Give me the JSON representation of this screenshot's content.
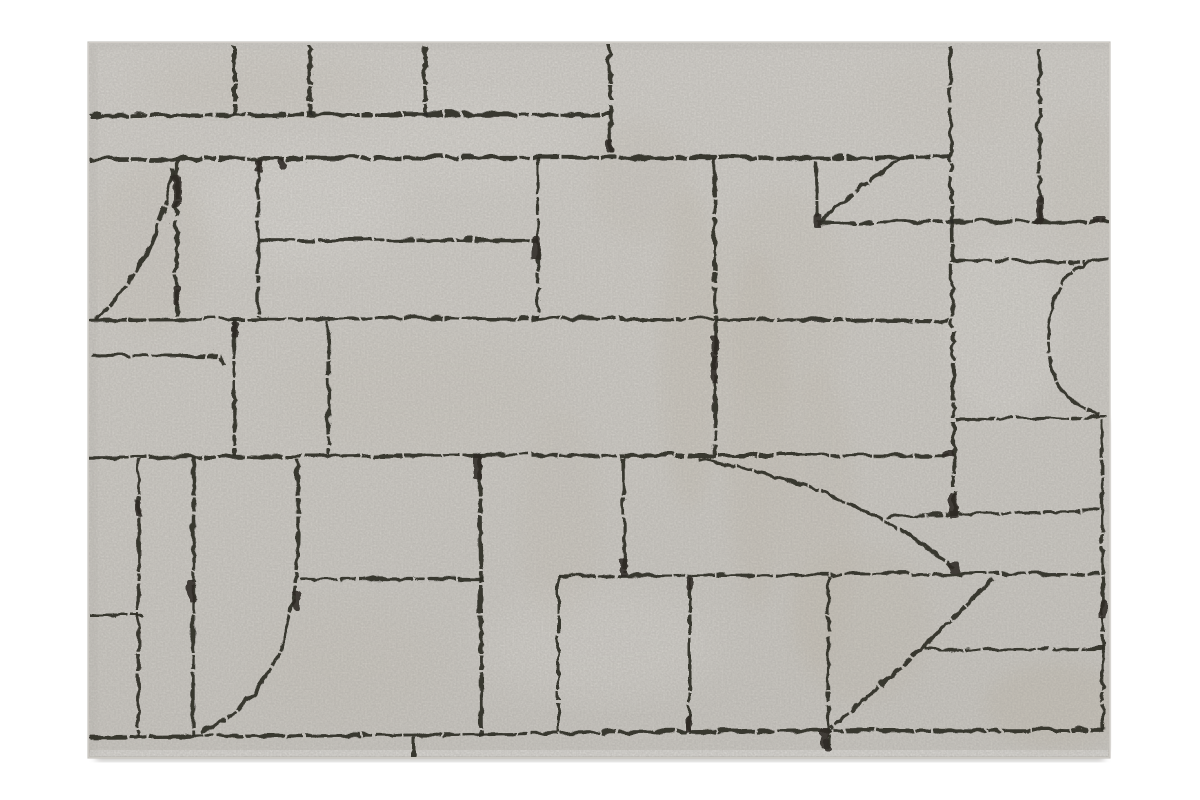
{
  "meta": {
    "description": "Product photograph of a rectangular cream greige area rug with an abstract hand-drawn charcoal line pattern of irregular blocks and quarter-circle curves, on a white background",
    "background_color": "#ffffff"
  },
  "rug": {
    "x": 88,
    "y": 42,
    "width": 1022,
    "height": 716,
    "base_color_top": "#dedbd6",
    "base_color_mid": "#d9d6d0",
    "base_color_bottom": "#d3d0ca",
    "edge_color": "#c6c3bd",
    "line_color": "#2d2a25",
    "pile_edge_color": "#e7e5e1"
  },
  "shadows": {
    "bottom": {
      "x": 96,
      "y": 750,
      "w": 1008,
      "h": 11,
      "color": "#8a8783",
      "opacity": 0.5
    },
    "right": {
      "x": 1106,
      "y": 420,
      "w": 5,
      "h": 330,
      "color": "#b3b0ab",
      "opacity": 0.35
    },
    "left_inner": {
      "x": 88,
      "y": 46,
      "w": 9,
      "h": 708,
      "color": "#c2bfb9",
      "opacity": 0.35
    },
    "top_inner": {
      "x": 88,
      "y": 42,
      "w": 1022,
      "h": 7,
      "color": "#c6c3bd",
      "opacity": 0.3
    }
  },
  "pattern": {
    "default_width": 3.2,
    "dash": "38 2 16 3 54 2 10 3 27 2",
    "lines": [
      {
        "n": "top-band-h",
        "d": "M88 114 L350 112.5 L608 113",
        "w": 4
      },
      {
        "n": "second-h",
        "d": "M88 158 L500 156 L948 156",
        "w": 4.2
      },
      {
        "n": "short-h-238",
        "d": "M257 239 L536 238",
        "w": 3.4
      },
      {
        "n": "h-318",
        "d": "M88 318 L400 316.5 L714 317.5 L948 319",
        "w": 3.6
      },
      {
        "n": "h-222-right",
        "d": "M816 222 L960 220 L1108 220",
        "w": 3.4
      },
      {
        "n": "h-353-left",
        "d": "M90 354 L218 355 L222 363",
        "w": 3.4
      },
      {
        "n": "h-258-right",
        "d": "M952 258 L1083 261",
        "w": 3
      },
      {
        "n": "h-454",
        "d": "M88 456 L500 453.5 L948 454",
        "w": 3.5
      },
      {
        "n": "h-417-right",
        "d": "M955 417 L1104 416",
        "w": 3
      },
      {
        "n": "h-512-right",
        "d": "M884 516 L955 512 L1099 509",
        "w": 2.8
      },
      {
        "n": "h-577-left",
        "d": "M298 577 L481 577",
        "w": 3.2
      },
      {
        "n": "h-573-right",
        "d": "M557 574 L820 573 L1097 572",
        "w": 3.2
      },
      {
        "n": "h-613-left",
        "d": "M88 613 L140 613",
        "w": 3
      },
      {
        "n": "h-647-right",
        "d": "M923 648 L1101 647",
        "w": 3
      },
      {
        "n": "h-bottom",
        "d": "M88 735 L412 733 L688 730 L828 728.5 L1102 728",
        "w": 3.8
      },
      {
        "n": "v-stub-233",
        "d": "M233 44 L233 113",
        "w": 4
      },
      {
        "n": "v-stub-308",
        "d": "M308 44 L308 113",
        "w": 3.8
      },
      {
        "n": "v-stub-423",
        "d": "M423 44 L423 113",
        "w": 3.8
      },
      {
        "n": "v-step-608",
        "d": "M608 43 L609 152",
        "w": 4
      },
      {
        "n": "v-948-long",
        "d": "M948 46 L951 300 L953 513",
        "w": 3.6
      },
      {
        "n": "v-1038",
        "d": "M1038 46 L1038 220",
        "w": 3.4
      },
      {
        "n": "v-175",
        "d": "M175 159 L175 316",
        "w": 4.2
      },
      {
        "n": "v-257",
        "d": "M257 159 L257 317",
        "w": 3.4
      },
      {
        "n": "v-537",
        "d": "M537 157 L537 317",
        "w": 3.2
      },
      {
        "n": "v-712",
        "d": "M713 157 L714 453",
        "w": 3.6
      },
      {
        "n": "v-814",
        "d": "M814 159 L815 219",
        "w": 3.4
      },
      {
        "n": "v-232",
        "d": "M232 319 L233 454",
        "w": 4
      },
      {
        "n": "v-327",
        "d": "M327 319 L327 453",
        "w": 3.2
      },
      {
        "n": "v-137",
        "d": "M137 456 L137 734",
        "w": 2.8
      },
      {
        "n": "v-192",
        "d": "M192 456 L192 733",
        "w": 3.4
      },
      {
        "n": "v-478",
        "d": "M478 456 L480 734",
        "w": 3.8
      },
      {
        "n": "v-557",
        "d": "M557 576 L557 730",
        "w": 3
      },
      {
        "n": "v-622",
        "d": "M622 456 L623 573",
        "w": 3.2
      },
      {
        "n": "v-688",
        "d": "M688 576 L688 728",
        "w": 3
      },
      {
        "n": "v-827",
        "d": "M827 575 L827 747",
        "w": 3.2
      },
      {
        "n": "v-1100",
        "d": "M1100 418 L1102 728",
        "w": 3.2
      },
      {
        "n": "tick-412",
        "d": "M412 734 L412 757",
        "w": 4
      },
      {
        "n": "curve-sail-top-left",
        "d": "M171 166 Q160 256 95 317",
        "w": 3.6
      },
      {
        "n": "curve-sail-top-mid",
        "d": "M899 158 Q857 186 818 220",
        "w": 3.4
      },
      {
        "n": "curve-c-right",
        "d": "M1107 257 Q1052 262 1047 330 Q1043 396 1097 412",
        "w": 3.2
      },
      {
        "n": "curve-sail-bottom-left",
        "d": "M296 456 C298 580 301 688 198 731",
        "w": 3.5
      },
      {
        "n": "curve-arc-middle",
        "d": "M696 457 Q862 487 954 569",
        "w": 3.3
      },
      {
        "n": "diagonal-bottom-right",
        "d": "M991 577 Q918 652 829 727",
        "w": 3.6
      }
    ],
    "blobs": [
      [
        471,
        452,
        8,
        26
      ],
      [
        530,
        234,
        8,
        24
      ],
      [
        709,
        334,
        7,
        46
      ],
      [
        947,
        490,
        9,
        26
      ],
      [
        811,
        212,
        9,
        14
      ],
      [
        1090,
        216,
        14,
        6
      ],
      [
        819,
        726,
        8,
        20
      ],
      [
        187,
        578,
        7,
        24
      ],
      [
        1098,
        598,
        7,
        20
      ],
      [
        229,
        320,
        7,
        16
      ],
      [
        1034,
        194,
        7,
        28
      ],
      [
        618,
        556,
        7,
        18
      ],
      [
        684,
        574,
        7,
        14
      ],
      [
        683,
        714,
        7,
        16
      ],
      [
        822,
        737,
        7,
        12
      ],
      [
        948,
        561,
        11,
        10
      ],
      [
        941,
        449,
        11,
        8
      ],
      [
        292,
        590,
        6,
        18
      ],
      [
        133,
        498,
        6,
        16
      ],
      [
        604,
        138,
        8,
        14
      ],
      [
        253,
        158,
        7,
        12
      ],
      [
        171,
        173,
        8,
        34
      ],
      [
        171,
        283,
        7,
        20
      ],
      [
        277,
        157,
        7,
        10
      ]
    ],
    "mottles": [
      {
        "cx": 260,
        "cy": 85,
        "rx": 120,
        "ry": 30,
        "f": "#cbc3b4",
        "o": 0.22
      },
      {
        "cx": 150,
        "cy": 250,
        "rx": 60,
        "ry": 85,
        "f": "#ccc4b6",
        "o": 0.2
      },
      {
        "cx": 420,
        "cy": 390,
        "rx": 140,
        "ry": 60,
        "f": "#cfc8ba",
        "o": 0.17
      },
      {
        "cx": 640,
        "cy": 180,
        "rx": 50,
        "ry": 60,
        "f": "#ccc4b6",
        "o": 0.2
      },
      {
        "cx": 690,
        "cy": 350,
        "rx": 30,
        "ry": 160,
        "f": "#cbc2b2",
        "o": 0.3
      },
      {
        "cx": 757,
        "cy": 430,
        "rx": 32,
        "ry": 180,
        "f": "#c9c0b0",
        "o": 0.28
      },
      {
        "cx": 820,
        "cy": 520,
        "rx": 36,
        "ry": 150,
        "f": "#ccc4b6",
        "o": 0.28
      },
      {
        "cx": 780,
        "cy": 300,
        "rx": 70,
        "ry": 110,
        "f": "#d0c9bc",
        "o": 0.25
      },
      {
        "cx": 862,
        "cy": 625,
        "rx": 70,
        "ry": 80,
        "f": "#cbc3b4",
        "o": 0.26
      },
      {
        "cx": 1055,
        "cy": 705,
        "rx": 70,
        "ry": 42,
        "f": "#c8bfae",
        "o": 0.35
      },
      {
        "cx": 950,
        "cy": 95,
        "rx": 85,
        "ry": 40,
        "f": "#d1cabe",
        "o": 0.16
      },
      {
        "cx": 350,
        "cy": 665,
        "rx": 95,
        "ry": 60,
        "f": "#cfc8ba",
        "o": 0.18
      },
      {
        "cx": 560,
        "cy": 520,
        "rx": 40,
        "ry": 110,
        "f": "#cdc5b7",
        "o": 0.2
      },
      {
        "cx": 1082,
        "cy": 180,
        "rx": 40,
        "ry": 70,
        "f": "#d0c9bc",
        "o": 0.18
      },
      {
        "cx": 300,
        "cy": 205,
        "rx": 100,
        "ry": 60,
        "f": "#eceae6",
        "o": 0.35
      },
      {
        "cx": 600,
        "cy": 645,
        "rx": 120,
        "ry": 55,
        "f": "#e9e7e3",
        "o": 0.3
      },
      {
        "cx": 1002,
        "cy": 330,
        "rx": 58,
        "ry": 90,
        "f": "#e9e7e3",
        "o": 0.3
      },
      {
        "cx": 470,
        "cy": 140,
        "rx": 110,
        "ry": 45,
        "f": "#e8e6e1",
        "o": 0.3
      }
    ]
  }
}
